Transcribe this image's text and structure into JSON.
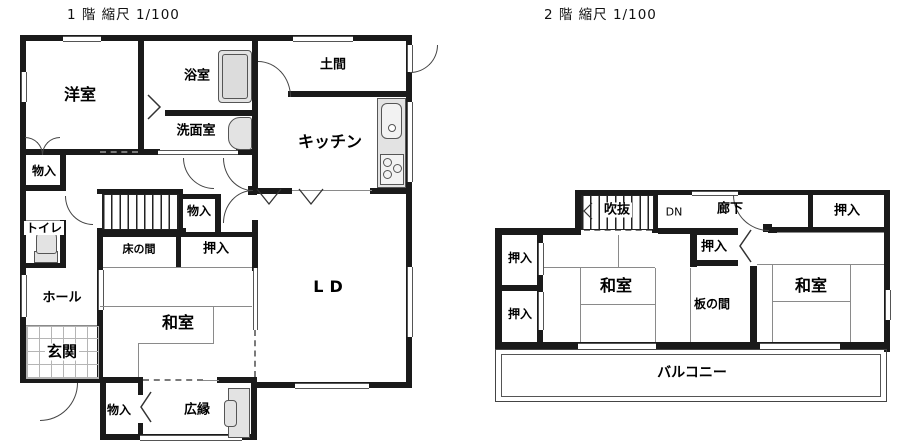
{
  "floor1": {
    "title": "1 階 縮尺 1/100",
    "labels": {
      "yoshitsu": "洋室",
      "yokushitsu": "浴室",
      "doma": "土間",
      "senmen": "洗面室",
      "kitchen": "キッチン",
      "mononyu": "物入",
      "toilet": "トイレ",
      "hall": "ホール",
      "genkan": "玄関",
      "tokonoma": "床の間",
      "oshiire": "押入",
      "washitsu": "和室",
      "ld": "LD",
      "hiroen": "広縁"
    }
  },
  "floor2": {
    "title": "2 階 縮尺 1/100",
    "labels": {
      "fukinuke": "吹抜",
      "dn": "DN",
      "rouka": "廊下",
      "oshiire": "押入",
      "washitsu": "和室",
      "itanoma": "板の間",
      "balcony": "バルコニー"
    }
  },
  "colors": {
    "wall": "#1a1a1a",
    "fixture": "#e3e3e3"
  }
}
